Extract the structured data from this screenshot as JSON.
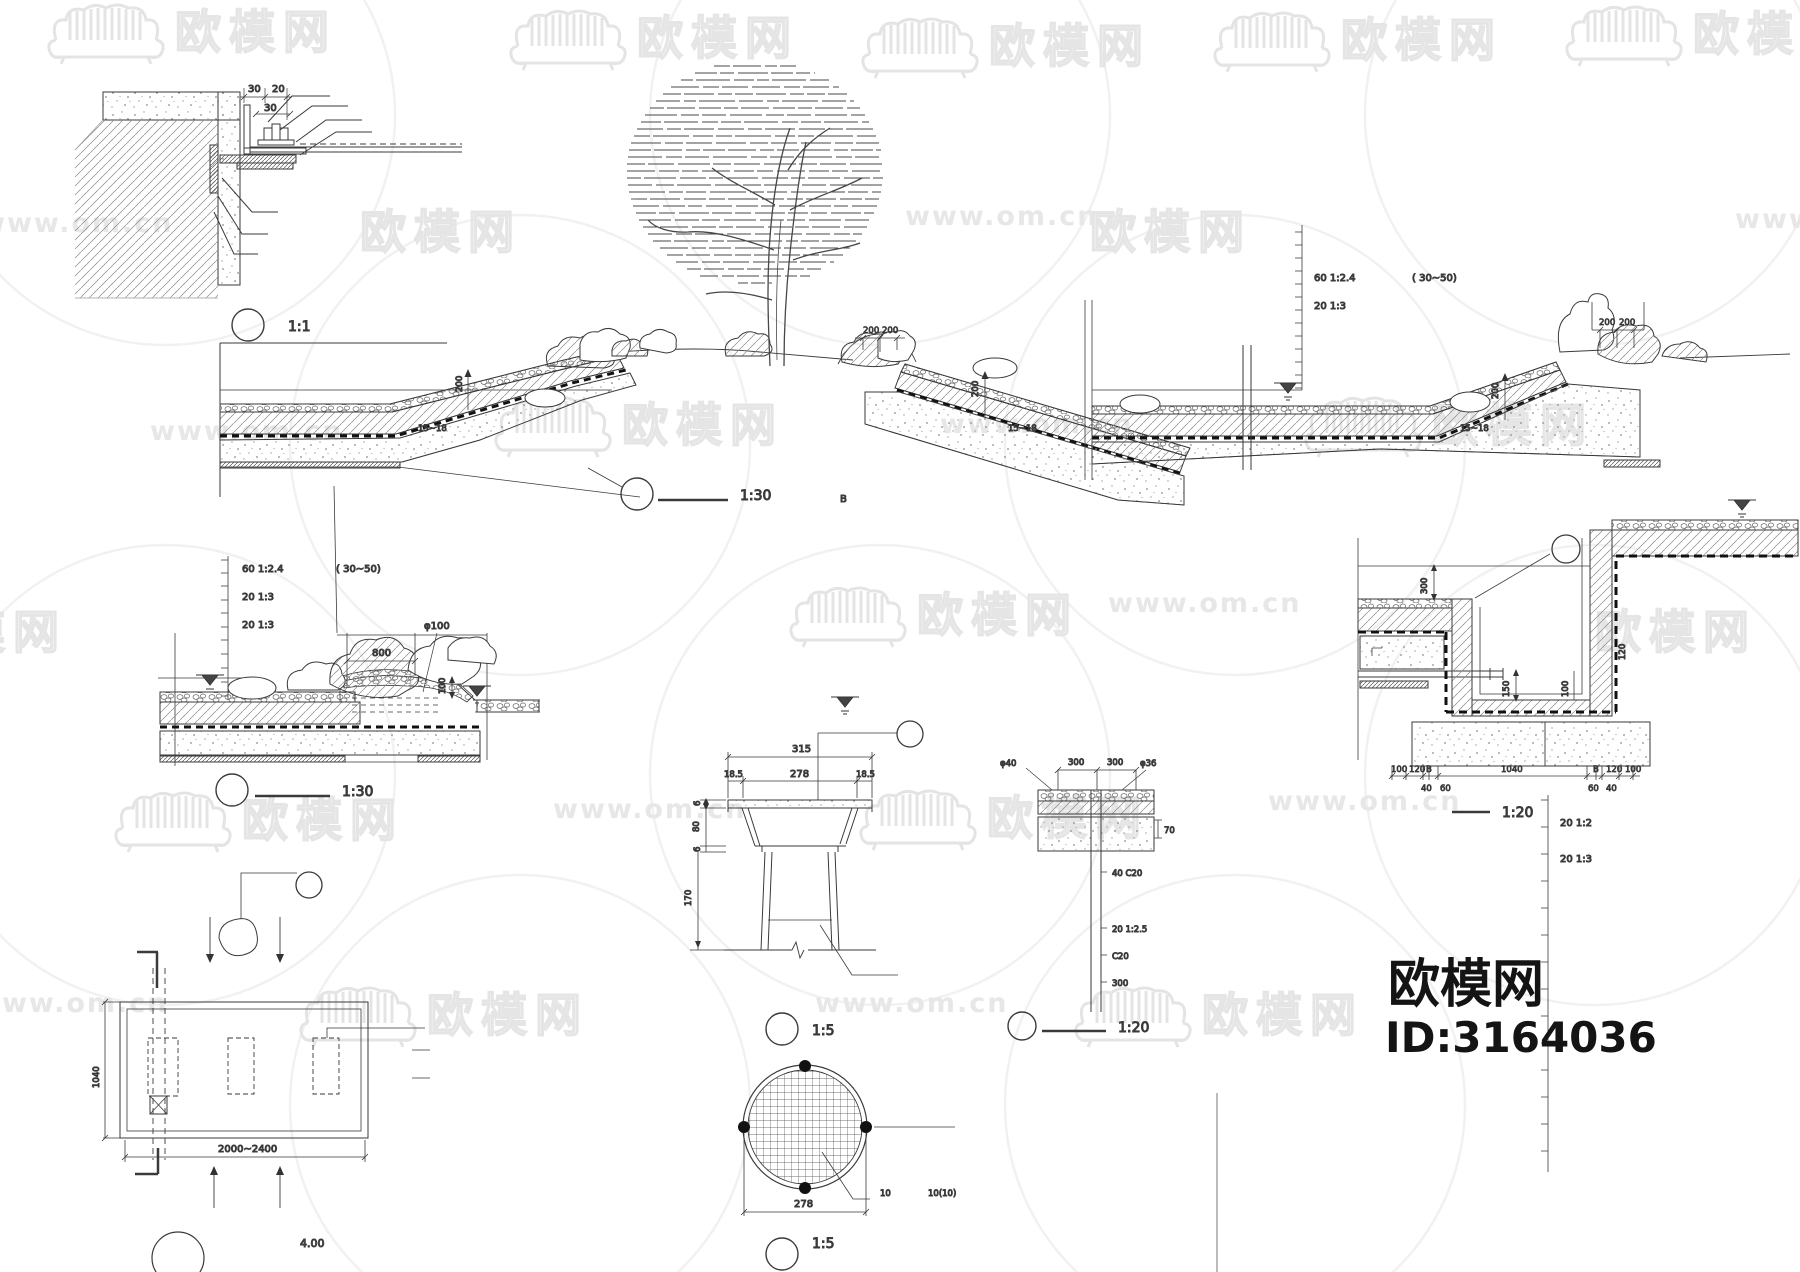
{
  "watermark": {
    "brand": "欧模网",
    "site": "www.om.cn"
  },
  "logo": {
    "brand": "欧模网",
    "id": "ID:3164036"
  },
  "corner_detail": {
    "scale": "1:1",
    "dim_30a": "30",
    "dim_20": "20",
    "dim_30b": "30"
  },
  "main_section": {
    "scale": "1:30",
    "section_ref": "B",
    "dim_200_l": "200",
    "dim_200_m": "200",
    "dim_200_r": "200",
    "mound1_200a": "200",
    "mound1_200b": "200",
    "mound2_200a": "200",
    "mound2_200b": "200",
    "slope_a": "15~18",
    "slope_b": "15~18",
    "slope_c": "15~18",
    "ruler_row1": "60  1:2.4",
    "ruler_row2": "20  1:3",
    "range": "(      30~50)"
  },
  "left_detail": {
    "scale": "1:30",
    "ruler_row1": "60  1:2.4",
    "ruler_row2": "20  1:3",
    "ruler_row3": "20  1:3",
    "range": "(      30~50)",
    "dim_800": "800",
    "dia_100": "φ100",
    "dim_100": "100"
  },
  "planter_detail": {
    "scale": "1:5",
    "dim_315": "315",
    "dim_185a": "18.5",
    "dim_278": "278",
    "dim_185b": "18.5",
    "dim_6a": "6",
    "dim_80": "80",
    "dim_6b": "6",
    "dim_170": "170"
  },
  "grate_detail": {
    "scale": "1:5",
    "dim_278": "278",
    "note_10": "10",
    "note_1010": "10(10)"
  },
  "plan_detail": {
    "dim_1040": "1040",
    "dim_2000": "2000~2400",
    "elev": "4.00"
  },
  "trench_detail": {
    "scale": "1:20",
    "dim_300": "300",
    "dim_150": "150",
    "dim_100r": "100",
    "dim_120w": "120",
    "chain_100a": "100",
    "chain_120a": "120",
    "chain_Ba": "B",
    "chain_40a": "40",
    "chain_60a": "60",
    "chain_1040": "1040",
    "chain_60b": "60",
    "chain_40b": "40",
    "chain_Bb": "B",
    "chain_120b": "120",
    "chain_100b": "100",
    "ruler_row1": "20  1:2",
    "ruler_row2": "20  1:3"
  },
  "pit_detail": {
    "scale": "1:20",
    "dia_40": "φ40",
    "dim_300a": "300",
    "dim_300b": "300",
    "dia_36": "φ36",
    "dim_70": "70",
    "note1": "40  C20",
    "note2": "20  1:2.5",
    "note3": "C20",
    "note4": "300"
  }
}
